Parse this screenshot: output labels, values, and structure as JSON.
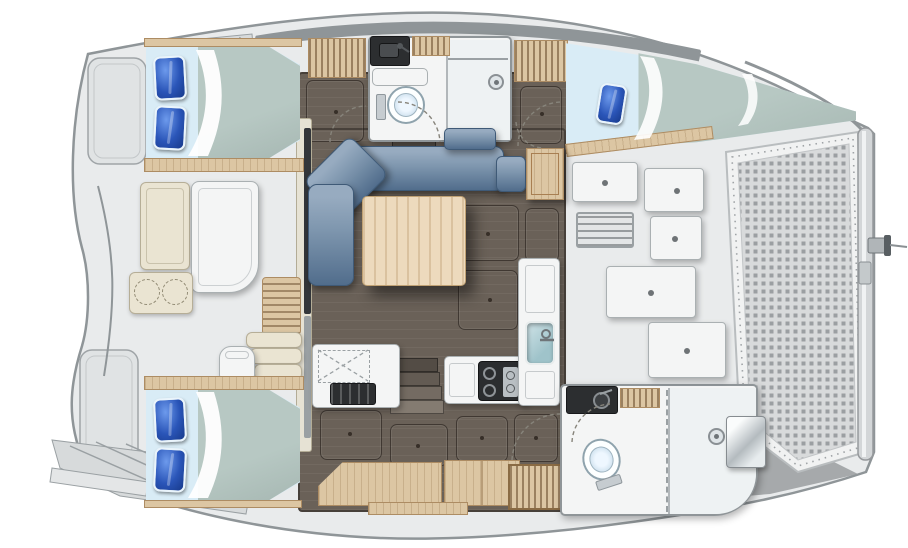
{
  "meta": {
    "title": "Catamaran interior layout floor plan",
    "view": "top-down",
    "orientation": "bow-right",
    "visible_text": "none"
  },
  "colors": {
    "deck": "#e9ebec",
    "deck_edge": "#8f9598",
    "floor_dark": "#6a6158",
    "floor_line": "#47403a",
    "wood": "#dcc6a3",
    "wood_dark": "#ad8c63",
    "pillow_blue": "#2a55b8",
    "sheet_blue": "#d9ecf6",
    "duvet_sage": "#b7c8c3",
    "sofa_blue": "#7e96ae",
    "sofa_edge": "#516d8c",
    "table_wood": "#eddabd",
    "white_furn": "#f4f5f5",
    "furn_edge": "#aab0b2",
    "cream": "#eae4d2",
    "cream_edge": "#b6ae97",
    "black_counter": "#2c2e30",
    "sink_teal": "#9fc3ca",
    "shower_floor": "#eef2f3",
    "mesh_dark": "#9b9fa2",
    "mesh_bg": "#d8dadb",
    "chrome_hi": "#fafcfc",
    "chrome_lo": "#b4bbbf"
  },
  "vessel": {
    "hull_top": {
      "rooms": [
        {
          "name": "aft-double-cabin",
          "items": [
            "double-bed",
            "two-blue-pillows",
            "sage-duvet",
            "wood-shelf"
          ]
        },
        {
          "name": "head-with-shower",
          "items": [
            "toilet",
            "black-vanity-sink",
            "wood-slat-shelf",
            "shower-drain",
            "door-swing"
          ]
        },
        {
          "name": "forward-double-cabin",
          "items": [
            "tapered-double-bed",
            "blue-pillow",
            "sage-duvet",
            "wood-shelf"
          ]
        }
      ],
      "lockers": [
        "wood-slat-locker-aft",
        "wood-slat-locker-forward"
      ]
    },
    "hull_bottom": {
      "rooms": [
        {
          "name": "aft-double-cabin",
          "items": [
            "double-bed",
            "two-blue-pillows",
            "sage-duvet",
            "wood-shelf"
          ]
        },
        {
          "name": "dressing-area",
          "items": [
            "wood-berth-surfaces",
            "wood-louvered-locker"
          ]
        },
        {
          "name": "forward-head-with-shower",
          "items": [
            "toilet",
            "black-vanity-sink",
            "shower-drain",
            "dashed-partition",
            "door-swing"
          ]
        }
      ]
    },
    "bridgedeck": {
      "salon": [
        "l-shaped-sofa",
        "wood-dining-table",
        "forward-bench",
        "nav-seat",
        "wood-chart-cabinet",
        "floor-hatch-panels"
      ],
      "galley": [
        "aft-counter-with-dashed-icebox",
        "dark-oven-grill",
        "cooktop-two-burners",
        "teal-sink-with-faucet",
        "tall-counter-column"
      ],
      "companionways": [
        "steps-to-top-hull",
        "steps-to-bottom-hull"
      ]
    },
    "cockpit": [
      "bench-seat",
      "cockpit-table",
      "cabinet-with-two-dashed-seats",
      "teak-slatted-bench",
      "aft-steps",
      "helm-chair",
      "sliding-door-track",
      "wood-sill"
    ],
    "foredeck": [
      "deck-hatch",
      "deck-hatch",
      "louvered-vent",
      "deck-hatch",
      "deck-panel",
      "deck-panel",
      "chrome-deck-locker",
      "shadow-wedge"
    ],
    "bow": [
      "trampoline-mesh",
      "lacing-border",
      "forward-crossbeam",
      "forestay-bracket",
      "forestay-line"
    ],
    "stern": [
      "swim-platform-top",
      "transom-steps-top",
      "swim-platform-bottom",
      "transom-steps-bottom",
      "boarding-step"
    ]
  },
  "counts": {
    "double_beds": 3,
    "toilets": 2,
    "showers": 2,
    "sinks": 3,
    "tables": 3
  }
}
